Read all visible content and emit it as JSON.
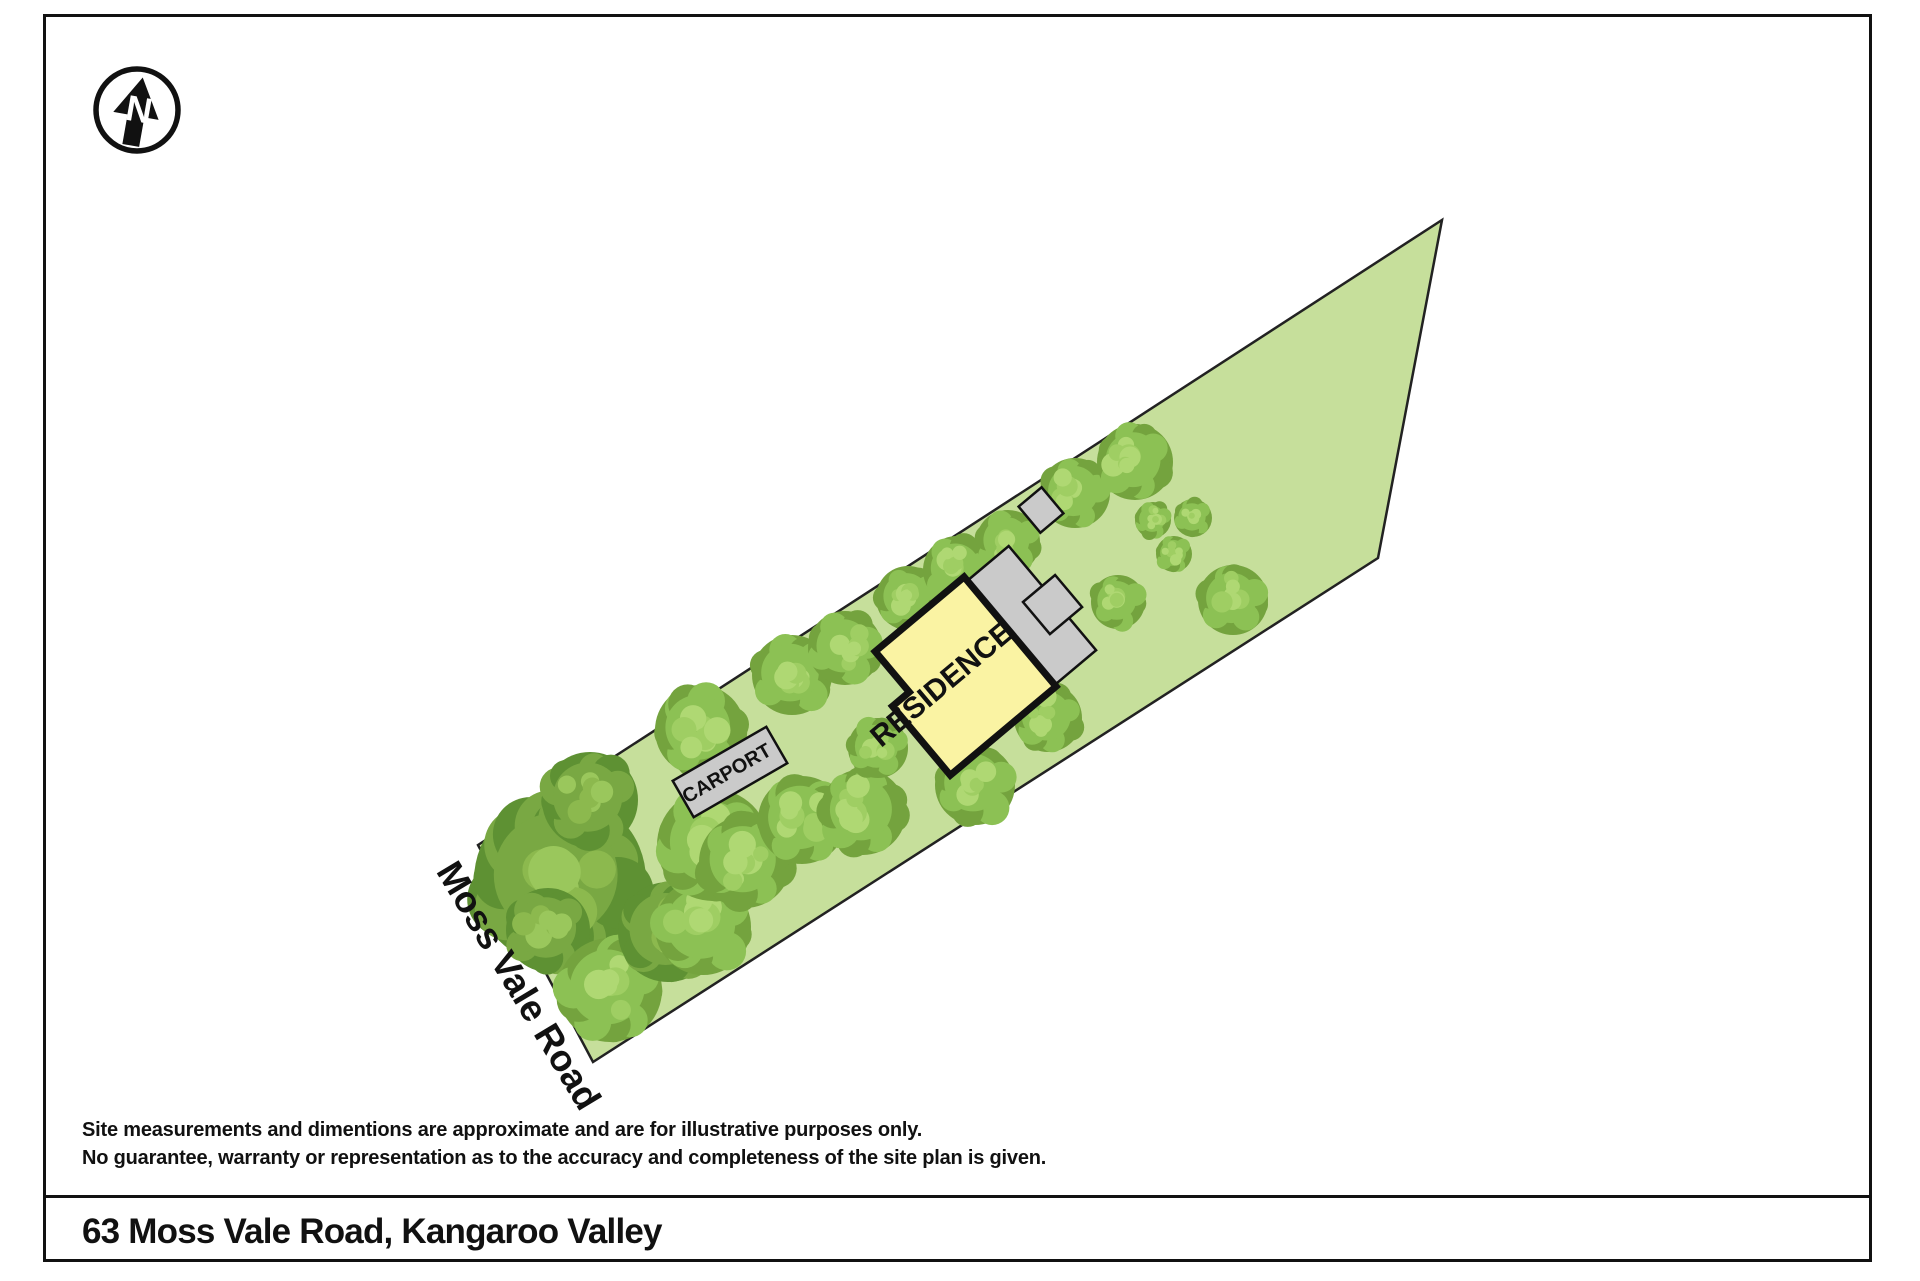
{
  "page": {
    "background": "#ffffff",
    "border_color": "#111111"
  },
  "north_arrow": {
    "label": "N",
    "rotation": 10,
    "ring_color": "#111111",
    "arrow_color": "#111111"
  },
  "site_plan": {
    "colors": {
      "parcel_fill": "#C6DF9B",
      "boundary_stroke": "#222222",
      "residence_fill": "#FAF3A3",
      "residence_stroke": "#111111",
      "structure_fill": "#CACACA",
      "structure_stroke": "#111111",
      "label_color": "#111111"
    },
    "tree_palettes": {
      "mid": [
        "#74A33E",
        "#8CC154",
        "#9FCE63",
        "#AFD873"
      ],
      "dark": [
        "#5E9133",
        "#79A843",
        "#8CB94E",
        "#9AC75C"
      ]
    },
    "parcel": {
      "points": [
        [
          478,
          845
        ],
        [
          1442,
          220
        ],
        [
          1378,
          558
        ],
        [
          593,
          1062
        ]
      ]
    },
    "road_label": {
      "text": "Moss Vale Road",
      "x": 508,
      "y": 992,
      "rotation": 59,
      "font_size": 37,
      "font_weight": 600
    },
    "residence": {
      "label": "RESIDENCE",
      "label_font_size": 30,
      "label_font_weight": 600,
      "cx": 940,
      "cy": 682,
      "rotation": -40,
      "polygon_local": [
        [
          86,
          -65
        ],
        [
          -30,
          -65
        ],
        [
          -30,
          -12
        ],
        [
          -52,
          -12
        ],
        [
          -52,
          78
        ],
        [
          86,
          78
        ]
      ],
      "stroke_width": 7
    },
    "decks": [
      {
        "local": [
          84,
          -60,
          56,
          136
        ]
      },
      {
        "local": [
          115,
          -8,
          42,
          42
        ]
      }
    ],
    "shed": {
      "cx": 1041,
      "cy": 510,
      "w": 30,
      "h": 34,
      "rotation": -40
    },
    "carport": {
      "label": "CARPORT",
      "label_font_size": 20,
      "label_font_weight": 600,
      "cx": 730,
      "cy": 772,
      "w": 108,
      "h": 42,
      "rotation": -30
    },
    "trees": [
      {
        "x": 560,
        "y": 880,
        "r": 86,
        "p": "dark"
      },
      {
        "x": 548,
        "y": 930,
        "r": 42,
        "p": "dark"
      },
      {
        "x": 610,
        "y": 990,
        "r": 52,
        "p": "mid"
      },
      {
        "x": 668,
        "y": 932,
        "r": 50,
        "p": "dark"
      },
      {
        "x": 703,
        "y": 927,
        "r": 48,
        "p": "mid"
      },
      {
        "x": 713,
        "y": 845,
        "r": 56,
        "p": "mid"
      },
      {
        "x": 590,
        "y": 800,
        "r": 48,
        "p": "dark"
      },
      {
        "x": 700,
        "y": 730,
        "r": 45,
        "p": "mid"
      },
      {
        "x": 745,
        "y": 862,
        "r": 46,
        "p": "mid"
      },
      {
        "x": 802,
        "y": 820,
        "r": 44,
        "p": "mid"
      },
      {
        "x": 792,
        "y": 675,
        "r": 40,
        "p": "mid"
      },
      {
        "x": 845,
        "y": 648,
        "r": 37,
        "p": "mid"
      },
      {
        "x": 863,
        "y": 812,
        "r": 43,
        "p": "mid"
      },
      {
        "x": 908,
        "y": 598,
        "r": 32,
        "p": "mid"
      },
      {
        "x": 957,
        "y": 570,
        "r": 34,
        "p": "mid"
      },
      {
        "x": 1008,
        "y": 542,
        "r": 32,
        "p": "mid"
      },
      {
        "x": 878,
        "y": 748,
        "r": 30,
        "p": "mid"
      },
      {
        "x": 975,
        "y": 785,
        "r": 40,
        "p": "mid"
      },
      {
        "x": 1048,
        "y": 718,
        "r": 34,
        "p": "mid"
      },
      {
        "x": 1075,
        "y": 493,
        "r": 35,
        "p": "mid"
      },
      {
        "x": 1135,
        "y": 462,
        "r": 38,
        "p": "mid"
      },
      {
        "x": 1153,
        "y": 520,
        "r": 18,
        "p": "mid"
      },
      {
        "x": 1193,
        "y": 518,
        "r": 19,
        "p": "mid"
      },
      {
        "x": 1174,
        "y": 554,
        "r": 18,
        "p": "mid"
      },
      {
        "x": 1118,
        "y": 602,
        "r": 27,
        "p": "mid"
      },
      {
        "x": 1233,
        "y": 600,
        "r": 35,
        "p": "mid"
      }
    ]
  },
  "footer": {
    "disclaimer_line1": "Site measurements and dimentions are approximate and are for illustrative purposes only.",
    "disclaimer_line2": "No guarantee, warranty or representation as to the accuracy and completeness of the site plan is given.",
    "address": "63 Moss Vale Road, Kangaroo Valley"
  }
}
